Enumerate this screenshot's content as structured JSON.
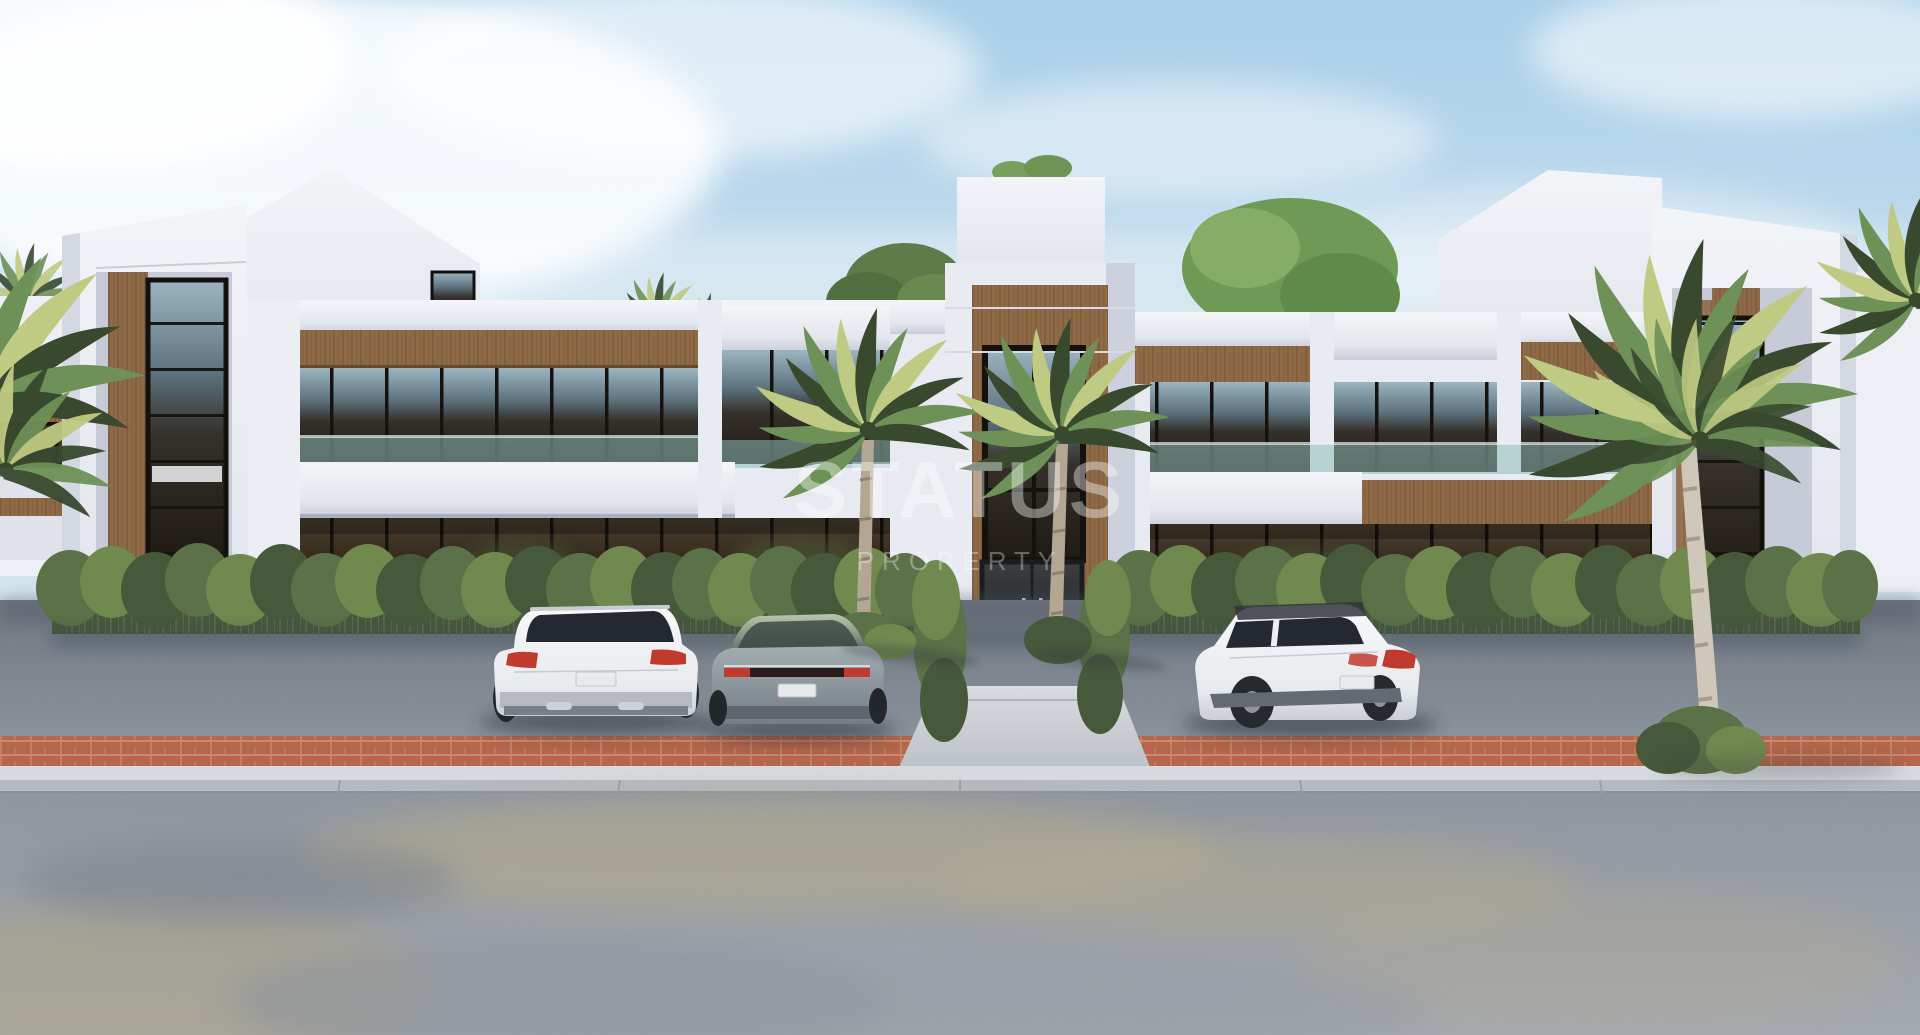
{
  "watermark": {
    "title": "STATUS",
    "subtitle": "PROPERTY"
  },
  "scene": {
    "subject": "modern two-storey residential complex exterior render",
    "vehicles": [
      "white suv",
      "gray sedan",
      "white suv"
    ],
    "landscaping": [
      "palm trees",
      "boxwood hedge row",
      "roof garden trees"
    ]
  },
  "palette": {
    "sky_top": "#a9cfe9",
    "wall": "#edeff5",
    "wall_shadow": "#cdd1dd",
    "wood": "#8f6a47",
    "wood_dark": "#6a4c30",
    "glass_dark": "#26211b",
    "teal": "#8fbcb6",
    "hedge": "#5b7148",
    "hedge_dark": "#46593b",
    "hedge_light": "#70894f",
    "palm_green": "#6d9157",
    "palm_yellow": "#bfca82",
    "palm_dark": "#38492e",
    "trunk": "#b3a693",
    "asphalt": "#818893",
    "brick": "#b5664c",
    "curb": "#d6dade",
    "road": "#9aa1a9",
    "sand": "#b1a98f",
    "car_white": "#f2f3f5",
    "car_gray": "#939ea4",
    "taillight": "#c03a2e",
    "watermark": "rgba(255,255,255,0.40)",
    "watermark_sub": "rgba(255,255,255,0.33)"
  }
}
